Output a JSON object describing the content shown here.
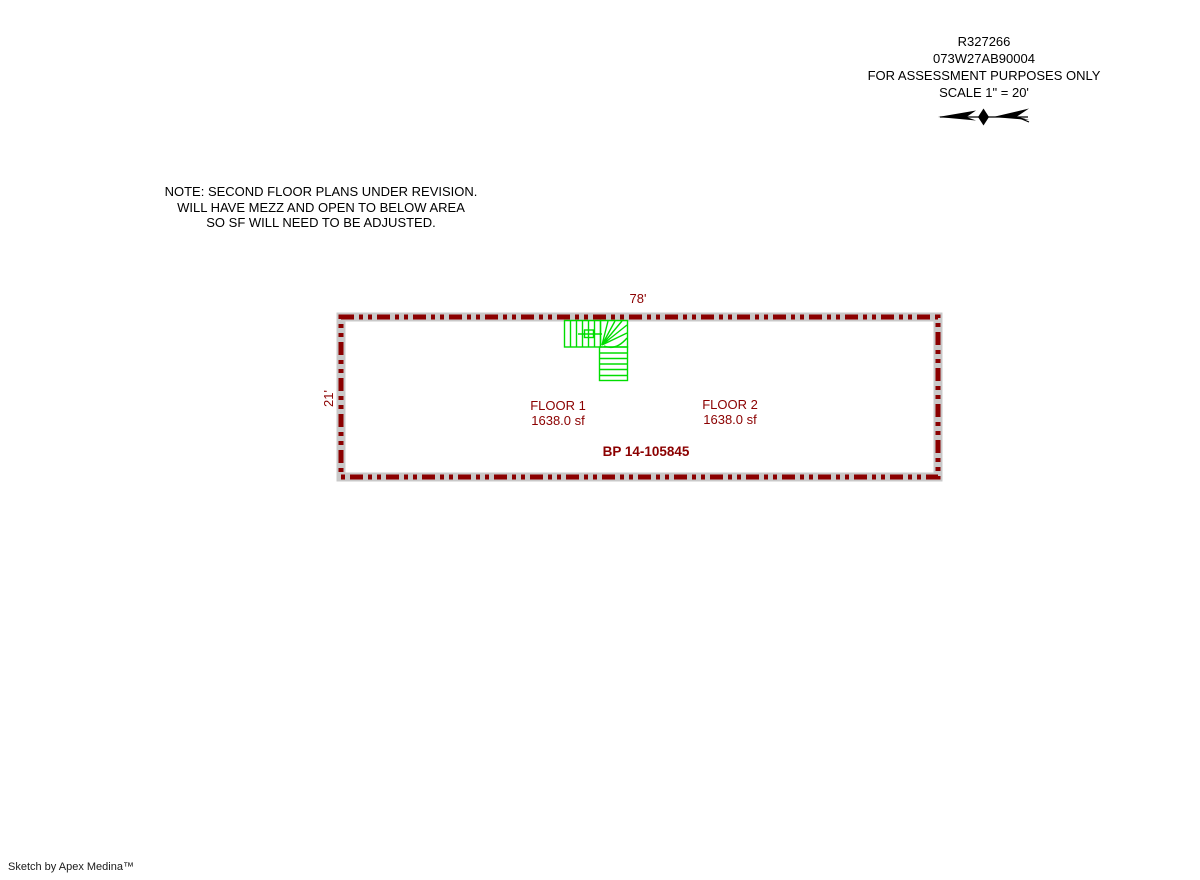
{
  "page": {
    "background": "#ffffff"
  },
  "header": {
    "record_id": "R327266",
    "parcel_id": "073W27AB90004",
    "purpose": "FOR ASSESSMENT PURPOSES ONLY",
    "scale": "SCALE 1\" = 20'"
  },
  "note": {
    "line1": "NOTE: SECOND FLOOR PLANS UNDER REVISION.",
    "line2": "WILL HAVE MEZZ AND OPEN TO BELOW AREA",
    "line3": "SO SF WILL NEED TO BE ADJUSTED."
  },
  "sketch": {
    "top_dimension": "78'",
    "left_dimension": "21'",
    "floor1": {
      "name": "FLOOR 1",
      "area": "1638.0 sf"
    },
    "floor2": {
      "name": "FLOOR 2",
      "area": "1638.0 sf"
    },
    "permit": "BP 14-105845",
    "colors": {
      "outline_red": "#8b0000",
      "outline_gray": "#c9c9c9",
      "stairs_green": "#00dd00",
      "label_red": "#8b0000"
    }
  },
  "footer": {
    "credit": "Sketch by Apex Medina™"
  }
}
